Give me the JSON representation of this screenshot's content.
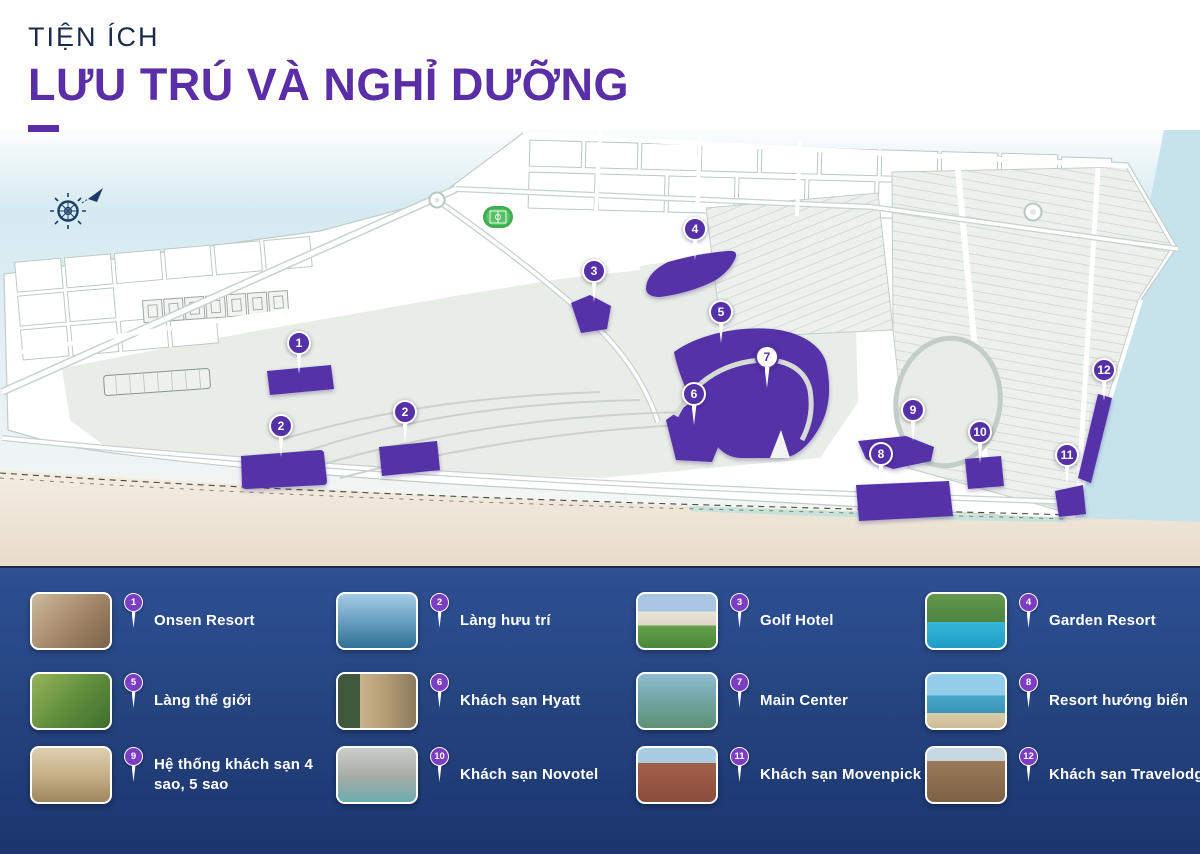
{
  "header": {
    "kicker": "TIỆN ÍCH",
    "title": "LƯU TRÚ VÀ NGHỈ DƯỠNG"
  },
  "map": {
    "markers": [
      {
        "n": "1"
      },
      {
        "n": "2"
      },
      {
        "n": "2"
      },
      {
        "n": "3"
      },
      {
        "n": "4"
      },
      {
        "n": "5"
      },
      {
        "n": "6"
      },
      {
        "n": "7"
      },
      {
        "n": "8"
      },
      {
        "n": "9"
      },
      {
        "n": "10"
      },
      {
        "n": "11"
      },
      {
        "n": "12"
      }
    ],
    "icons": [
      "compass-rose",
      "football-field"
    ]
  },
  "legend": {
    "items": [
      {
        "number": "1",
        "label": "Onsen Resort"
      },
      {
        "number": "2",
        "label": "Làng hưu trí"
      },
      {
        "number": "3",
        "label": "Golf Hotel"
      },
      {
        "number": "4",
        "label": "Garden Resort"
      },
      {
        "number": "5",
        "label": "Làng thế giới"
      },
      {
        "number": "6",
        "label": "Khách sạn Hyatt"
      },
      {
        "number": "7",
        "label": "Main Center"
      },
      {
        "number": "8",
        "label": "Resort hướng biển"
      },
      {
        "number": "9",
        "label": "Hệ thống khách sạn 4 sao, 5 sao"
      },
      {
        "number": "10",
        "label": "Khách sạn Novotel"
      },
      {
        "number": "11",
        "label": "Khách sạn Movenpick"
      },
      {
        "number": "12",
        "label": "Khách sạn Travelodge"
      }
    ]
  },
  "colors": {
    "accent_purple": "#5531a8",
    "pin_purple": "#7b3ec2",
    "title_navy": "#1b2b4e",
    "title_purple": "#5a2ea6",
    "panel_blue": "#24437f",
    "sky_blue": "#d7ebf1",
    "sea_blue": "#c6e3eb",
    "sand": "#efe6da"
  }
}
